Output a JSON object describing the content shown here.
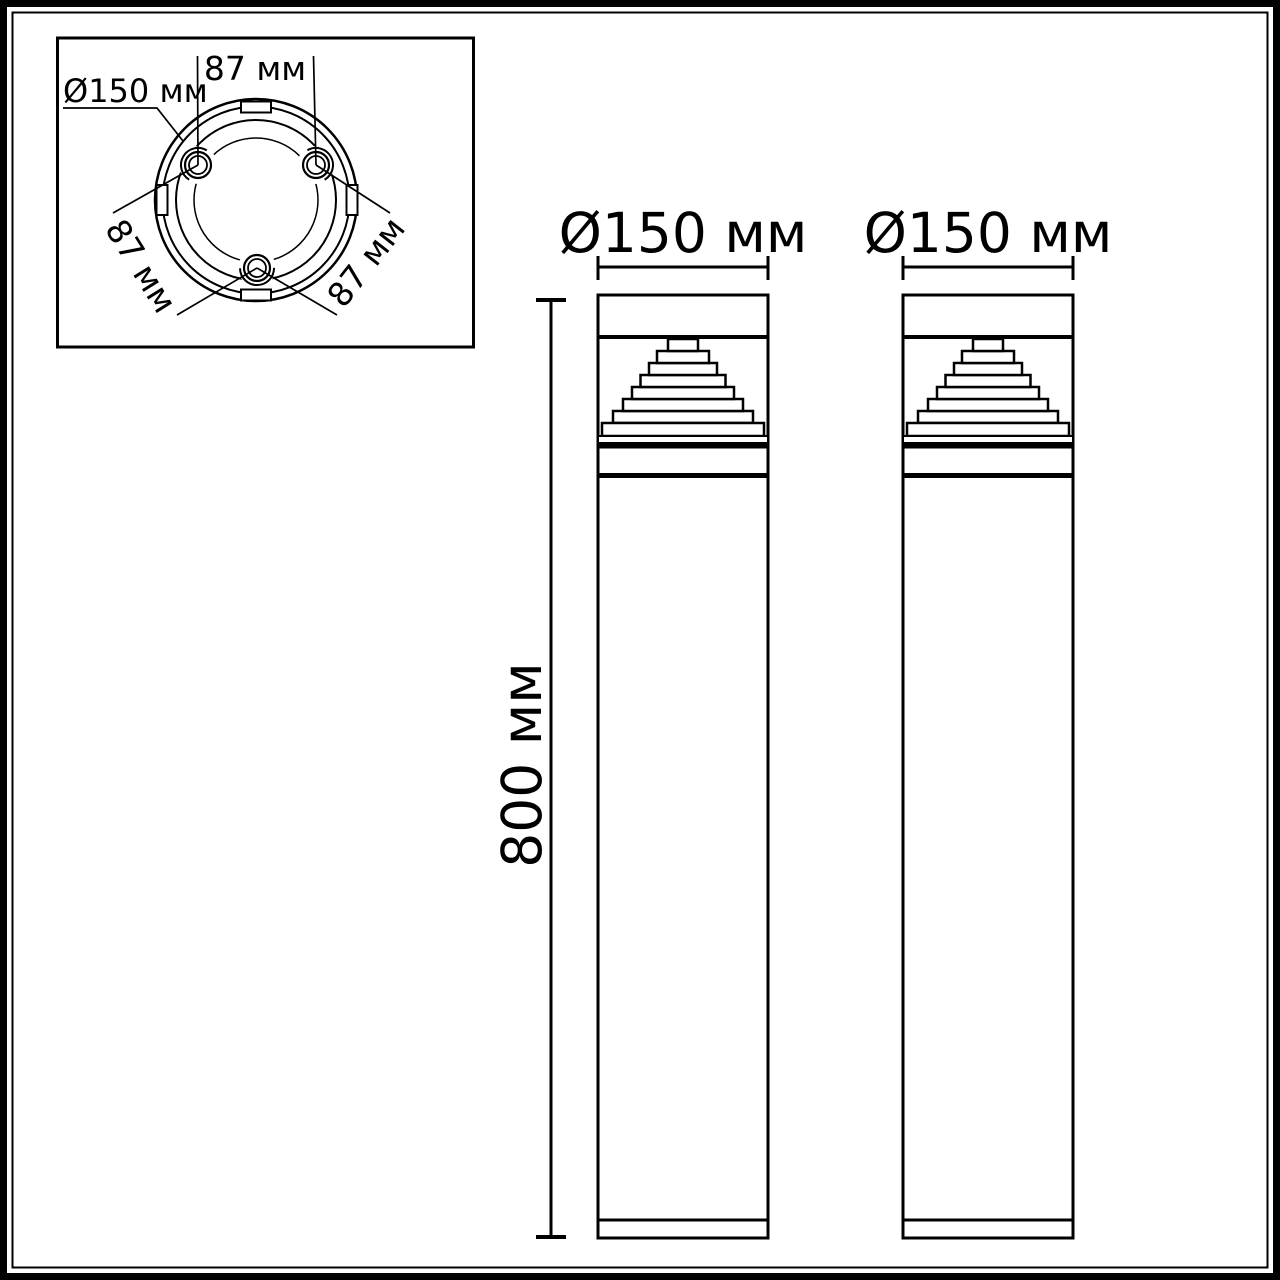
{
  "drawing": {
    "background_color": "#ffffff",
    "line_color": "#000000",
    "units": "мм",
    "top_view": {
      "diameter_label": "Ø150 мм",
      "spacing_label_top": "87 мм",
      "spacing_label_left": "87 мм",
      "spacing_label_right": "87 мм"
    },
    "front_view_left": {
      "diameter_label": "Ø150 мм"
    },
    "front_view_right": {
      "diameter_label": "Ø150 мм"
    },
    "height_label": "800 мм"
  }
}
